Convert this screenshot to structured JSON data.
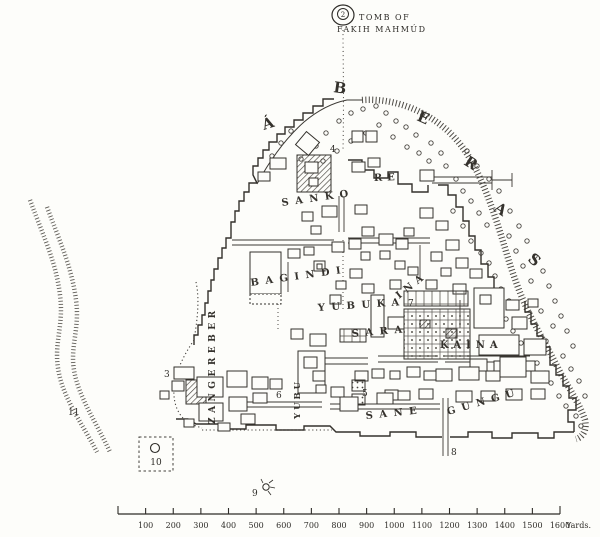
{
  "map": {
    "tomb": {
      "label_number": "2",
      "name_line1": "TOMB OF",
      "name_line2": "FAKIH MAHMÚD"
    },
    "outer_letters": [
      "Á",
      "B",
      "E",
      "R",
      "A",
      "S"
    ],
    "quarters": {
      "sankore_left": "SANKO",
      "sankore_right": "RE",
      "bagindi": "BAGINDI",
      "yubukaina_main": "YUBUKA",
      "yubukaina_tail": "INA",
      "sara": "SARA",
      "kaina": "KAINA",
      "sane": "SANE",
      "gungu": "GUNGU",
      "zangereber": "ZANGEREBER",
      "yubu": "YUBU"
    },
    "numbers": {
      "n3": "3",
      "n4": "4",
      "n5": "5",
      "n6": "6",
      "n7": "7",
      "n8": "8",
      "n9": "9",
      "n10": "10",
      "n11": "11"
    }
  },
  "scale_bar": {
    "tick_labels": [
      "100",
      "200",
      "300",
      "400",
      "500",
      "600",
      "700",
      "800",
      "900",
      "1000",
      "1100",
      "1200",
      "1300",
      "1400",
      "1500",
      "1600"
    ],
    "unit_label": "Yards."
  },
  "colors": {
    "ink": "#2e2c28",
    "paper": "#fdfdfa"
  }
}
